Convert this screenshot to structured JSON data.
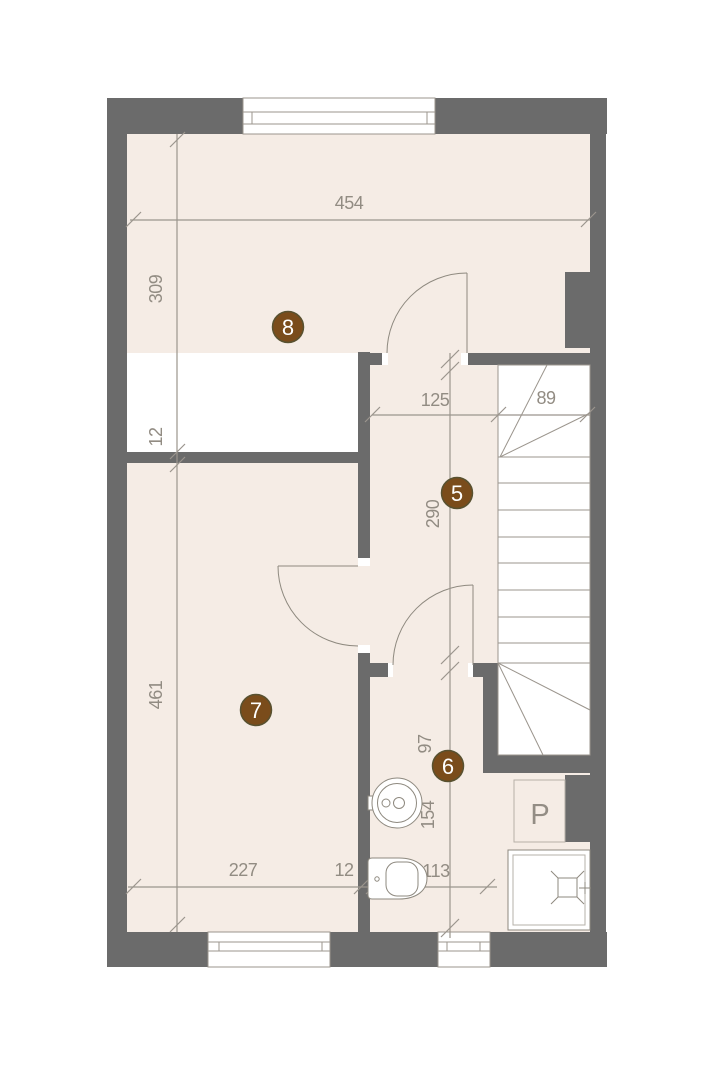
{
  "colors": {
    "wall": "#6b6b6b",
    "floor": "#f5ece5",
    "page": "#ffffff",
    "stairs_fill": "#ffffff",
    "plan_line": "#9b958d",
    "fixture_line": "#8e897f",
    "dimension_text": "#928c83",
    "room_marker_fill": "#7a4c1b",
    "room_marker_rim": "#585130",
    "room_marker_text": "#ffffff"
  },
  "rooms": {
    "room8": {
      "label": "8"
    },
    "room5": {
      "label": "5"
    },
    "room7": {
      "label": "7"
    },
    "room6": {
      "label": "6"
    }
  },
  "dimensions": {
    "total_width": {
      "label": "454"
    },
    "room8_depth": {
      "label": "309"
    },
    "wall_upper": {
      "label": "12"
    },
    "room7_depth": {
      "label": "461"
    },
    "hall_width": {
      "label": "125"
    },
    "stair_width": {
      "label": "89"
    },
    "hall_depth": {
      "label": "290"
    },
    "bath_upper": {
      "label": "97"
    },
    "bath_lower": {
      "label": "154"
    },
    "room7_width": {
      "label": "227"
    },
    "wall_lower": {
      "label": "12"
    },
    "bath_width": {
      "label": "113"
    }
  },
  "fixtures": {
    "washer": {
      "label": "P"
    }
  }
}
